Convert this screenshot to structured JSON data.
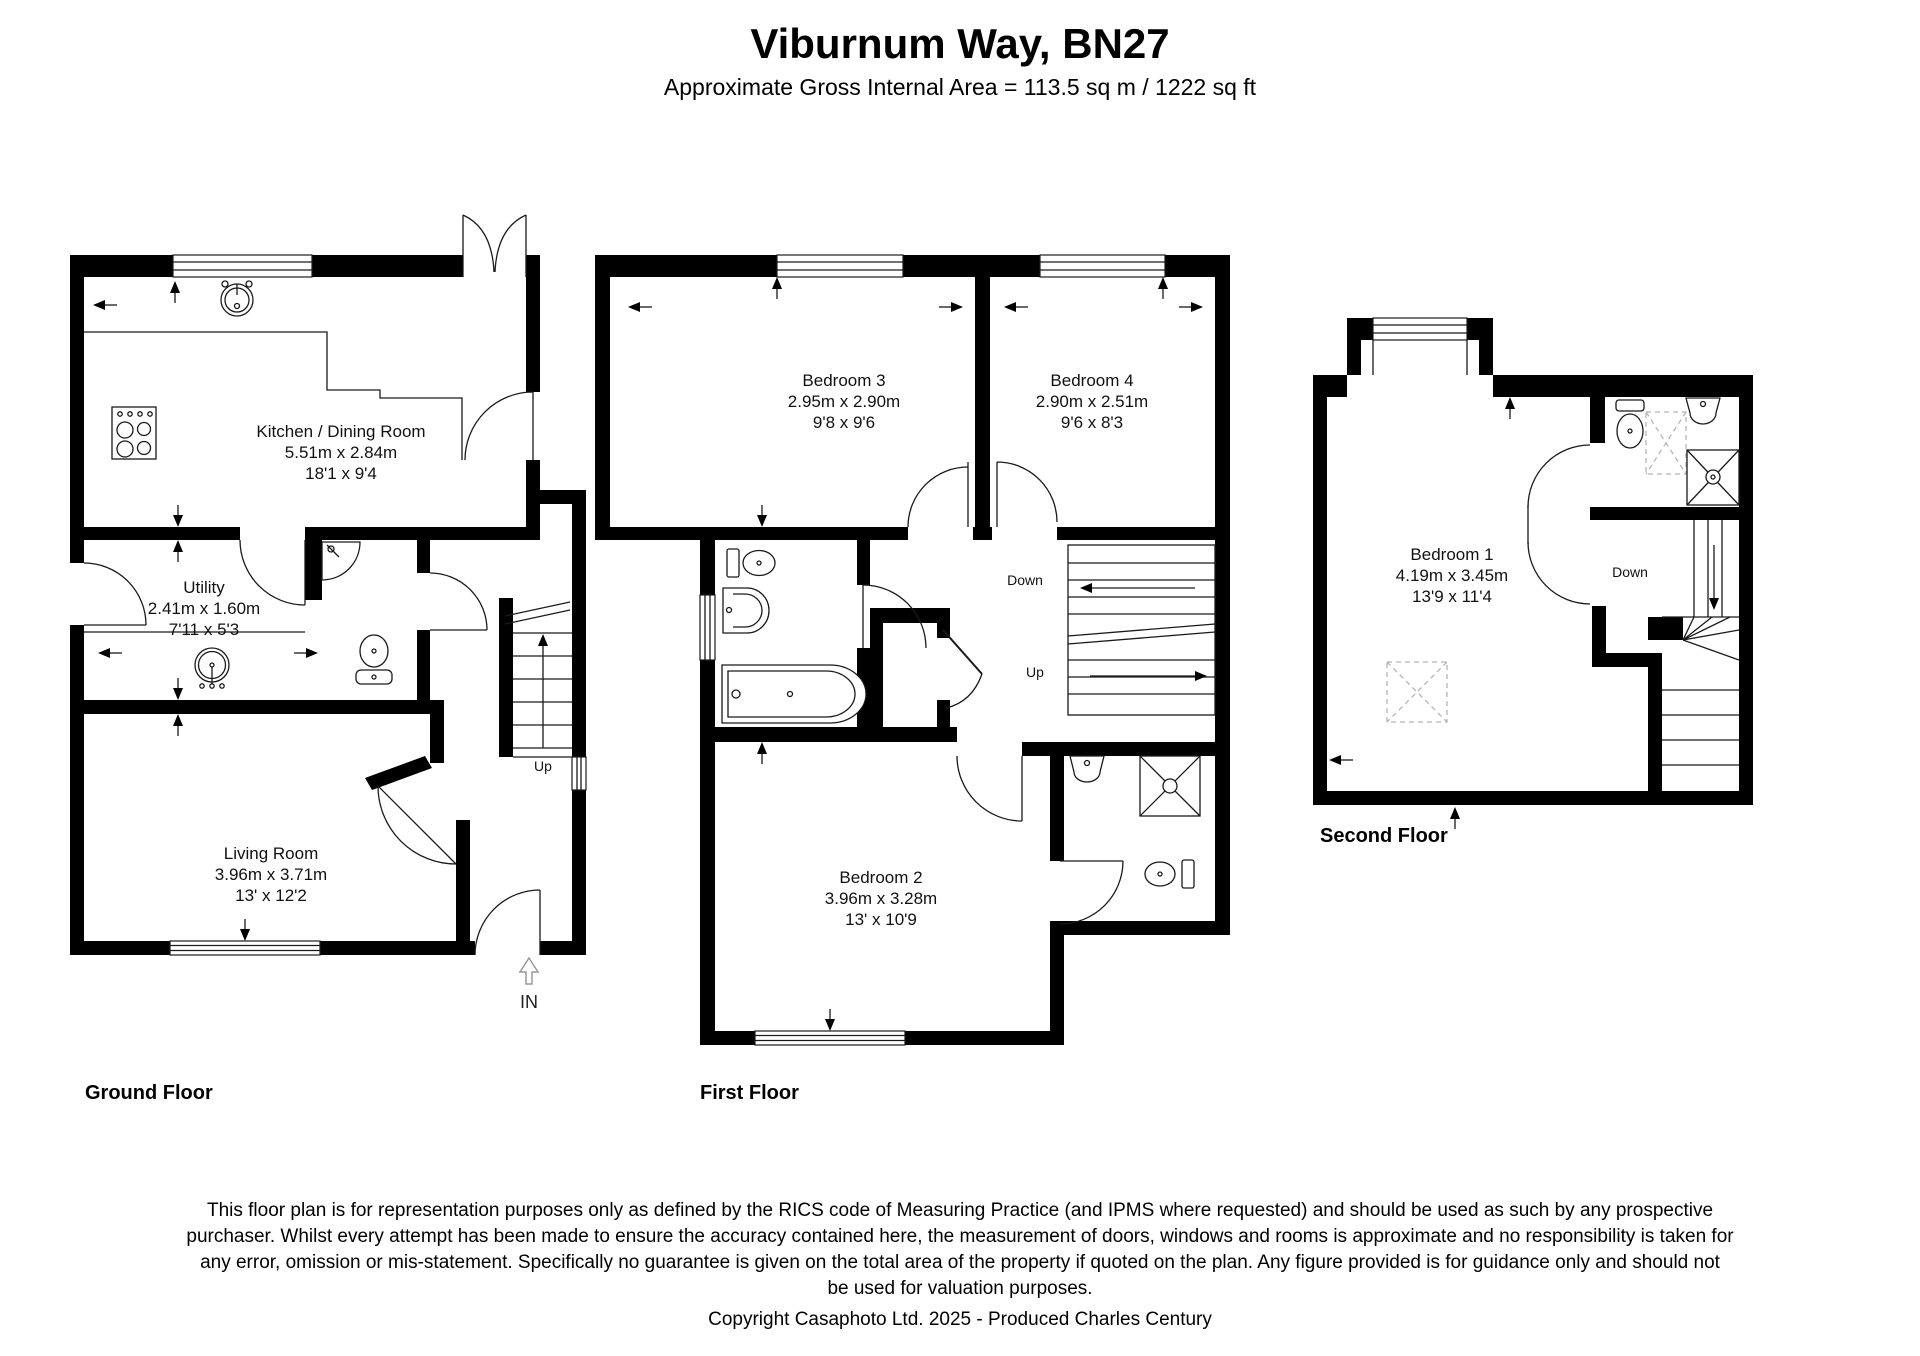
{
  "header": {
    "title": "Viburnum Way, BN27",
    "subtitle": "Approximate Gross Internal Area = 113.5 sq m / 1222 sq ft"
  },
  "floors": {
    "ground": {
      "label": "Ground Floor",
      "stairs_up": "Up",
      "entrance": "IN",
      "rooms": {
        "kitchen": {
          "name": "Kitchen / Dining Room",
          "metric": "5.51m x 2.84m",
          "imperial": "18'1 x 9'4"
        },
        "utility": {
          "name": "Utility",
          "metric": "2.41m x 1.60m",
          "imperial": "7'11 x 5'3"
        },
        "living": {
          "name": "Living Room",
          "metric": "3.96m x 3.71m",
          "imperial": "13' x 12'2"
        }
      }
    },
    "first": {
      "label": "First Floor",
      "stairs_down": "Down",
      "stairs_up": "Up",
      "rooms": {
        "bedroom3": {
          "name": "Bedroom 3",
          "metric": "2.95m x 2.90m",
          "imperial": "9'8 x 9'6"
        },
        "bedroom4": {
          "name": "Bedroom 4",
          "metric": "2.90m x 2.51m",
          "imperial": "9'6 x 8'3"
        },
        "bedroom2": {
          "name": "Bedroom 2",
          "metric": "3.96m x 3.28m",
          "imperial": "13' x 10'9"
        }
      }
    },
    "second": {
      "label": "Second Floor",
      "stairs_down": "Down",
      "rooms": {
        "bedroom1": {
          "name": "Bedroom 1",
          "metric": "4.19m x 3.45m",
          "imperial": "13'9 x 11'4"
        }
      }
    }
  },
  "footer": {
    "lines": [
      "This floor plan is for representation purposes only as defined by the RICS code of Measuring Practice (and IPMS where requested) and should be used as such by any prospective",
      "purchaser. Whilst every attempt has been made to ensure the accuracy contained here, the measurement of doors, windows and rooms is approximate and no responsibility is taken for",
      "any error, omission or mis-statement. Specifically no guarantee is given on the total area of the property if quoted on the plan. Any figure provided is for guidance only and should not",
      "be used for valuation purposes."
    ],
    "copyright": "Copyright Casaphoto Ltd. 2025 - Produced Charles Century"
  },
  "colors": {
    "wall": "#000000",
    "line": "#1a1a1a",
    "dashed": "#b5b5b5"
  }
}
